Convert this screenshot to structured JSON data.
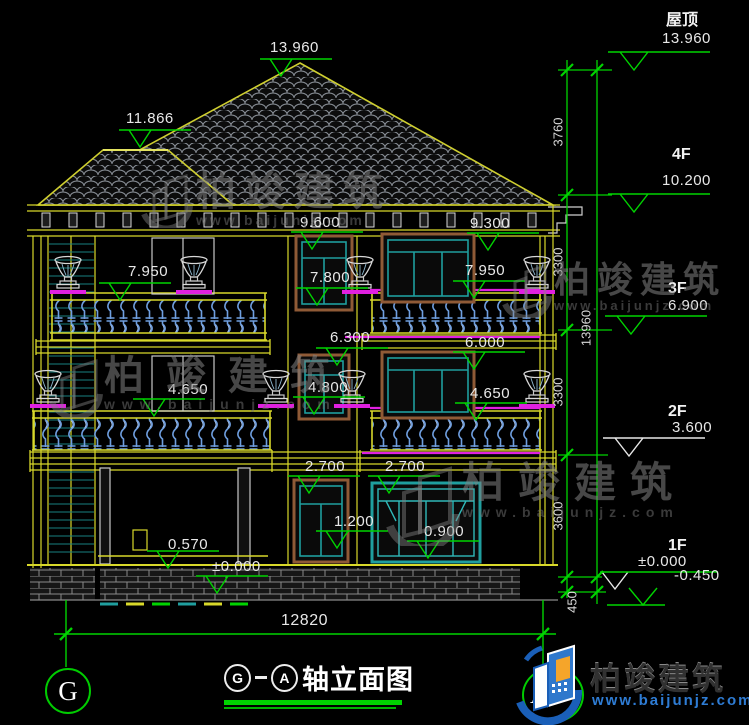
{
  "drawing": {
    "bottom_dim": "12820",
    "axis_left": "G",
    "axis_right": "A",
    "title": {
      "axis_start": "G",
      "axis_end": "A",
      "suffix": "轴立面图"
    }
  },
  "right_levels": [
    {
      "floor": "屋顶",
      "elev": "13.960"
    },
    {
      "floor": "4F",
      "elev": "10.200"
    },
    {
      "floor": "3F",
      "elev": "6.900"
    },
    {
      "floor": "2F",
      "elev": "3.600"
    },
    {
      "floor": "1F",
      "elev": "±0.000",
      "below": "-0.450"
    }
  ],
  "vdims": {
    "s1": "3760",
    "s2": "3300",
    "s3": "3300",
    "s4": "3600",
    "s5": "450",
    "total": "13960"
  },
  "spots": {
    "ridge": "13.960",
    "left_ridge": "11.866",
    "eave_left": "9.600",
    "eave_right": "9.300",
    "rail3_left": "7.950",
    "win3_center": "7.800",
    "rail3_right": "7.950",
    "slab3_center": "6.300",
    "slab3_right": "6.000",
    "rail2_left": "4.650",
    "win2_center": "4.800",
    "rail2_right": "4.650",
    "slab2_left": "2.700",
    "slab2_right": "2.700",
    "sill1_center": "1.200",
    "sill1_right": "0.900",
    "porch": "0.570",
    "ground": "±0.000"
  },
  "watermark": {
    "brand": "柏竣建筑",
    "url": "www.baijunjz.com"
  },
  "logo": {
    "brand": "柏竣建筑",
    "url": "www.baijunjz.com"
  },
  "colors": {
    "line_green": "#00d400",
    "line_yellow": "#d8d82a",
    "magenta": "#e020e0",
    "teal": "#1f9e9e",
    "frame_brown": "#8f5a36",
    "baluster_blue": "#6f9fe0",
    "text_white": "#e8e8e8"
  }
}
